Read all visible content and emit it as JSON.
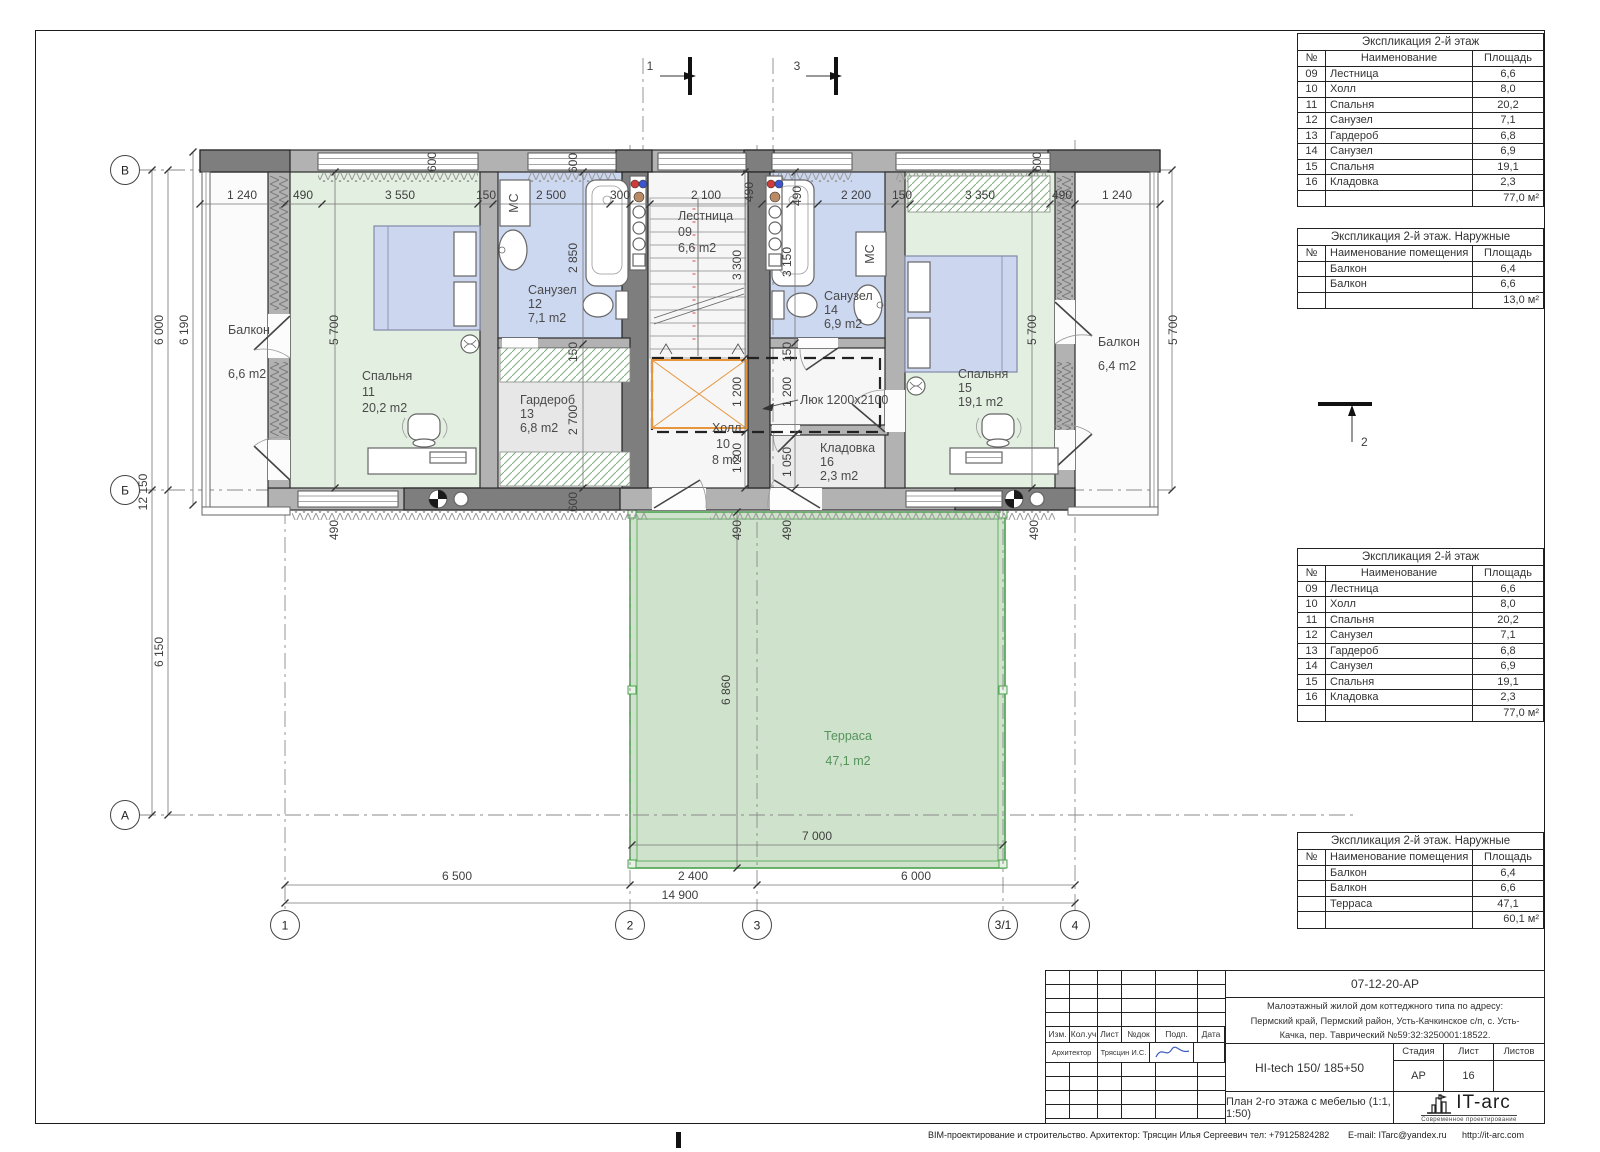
{
  "colors": {
    "wall": "#b2b2b2",
    "wall_dark": "#7e7e7e",
    "bedroom": "#e3efe0",
    "bath": "#ccd7f0",
    "wardrobe": "#e7e7e7",
    "terrace_fill": "#cfe2cb",
    "terrace_border": "#4aa14e",
    "bed": "#cdd6ef",
    "hatch_orange": "#e8963e"
  },
  "tables": {
    "floor": {
      "title": "Экспликация 2-й этаж",
      "cols": [
        "№",
        "Наименование",
        "Площадь"
      ],
      "rows": [
        [
          "09",
          "Лестница",
          "6,6"
        ],
        [
          "10",
          "Холл",
          "8,0"
        ],
        [
          "11",
          "Спальня",
          "20,2"
        ],
        [
          "12",
          "Санузел",
          "7,1"
        ],
        [
          "13",
          "Гардероб",
          "6,8"
        ],
        [
          "14",
          "Санузел",
          "6,9"
        ],
        [
          "15",
          "Спальня",
          "19,1"
        ],
        [
          "16",
          "Кладовка",
          "2,3"
        ]
      ],
      "total": "77,0 м²"
    },
    "outdoor_top": {
      "title": "Экспликация 2-й этаж. Наружные",
      "cols": [
        "№",
        "Наименование помещения",
        "Площадь"
      ],
      "rows": [
        [
          "",
          "Балкон",
          "6,4"
        ],
        [
          "",
          "Балкон",
          "6,6"
        ]
      ],
      "total": "13,0 м²"
    },
    "outdoor_bottom": {
      "title": "Экспликация 2-й этаж. Наружные",
      "cols": [
        "№",
        "Наименование помещения",
        "Площадь"
      ],
      "rows": [
        [
          "",
          "Балкон",
          "6,4"
        ],
        [
          "",
          "Балкон",
          "6,6"
        ],
        [
          "",
          "Терраса",
          "47,1"
        ]
      ],
      "total": "60,1 м²"
    }
  },
  "stamp": {
    "doc_number": "07-12-20-АР",
    "address1": "Малоэтажный жилой дом коттеджного типа по адресу:",
    "address2": "Пермский край, Пермский район, Усть-Качкинское с/п, с. Усть-",
    "address3": "Качка, пер. Таврический №59:32:3250001:18522.",
    "cols": [
      "Изм.",
      "Кол.уч",
      "Лист",
      "№док",
      "Подп.",
      "Дата"
    ],
    "grid_empty_top": [
      [
        "",
        "",
        "",
        "",
        "",
        ""
      ],
      [
        "",
        "",
        "",
        "",
        "",
        ""
      ],
      [
        "",
        "",
        "",
        "",
        "",
        ""
      ],
      [
        "",
        "",
        "",
        "",
        "",
        ""
      ]
    ],
    "grid_empty_bottom": [
      [
        "",
        "",
        "",
        "",
        "",
        ""
      ],
      [
        "",
        "",
        "",
        "",
        "",
        ""
      ],
      [
        "",
        "",
        "",
        "",
        "",
        ""
      ],
      [
        "",
        "",
        "",
        "",
        "",
        ""
      ]
    ],
    "architect_role": "Архитектор",
    "architect_name": "Трясцин И.С.",
    "project": "HI-tech 150/ 185+50",
    "stage_label": "Стадия",
    "sheet_label": "Лист",
    "sheets_label": "Листов",
    "stage": "АР",
    "sheet": "16",
    "sheets": "",
    "drawing_title": "План 2-го этажа с мебелью (1:1, 1:50)",
    "logo": "IT-arc",
    "logo_sub": "Современное проектирование"
  },
  "footer": {
    "item1": "BIM-проектирование и строительство.",
    "item2": "Архитектор: Трясцин Илья Сергеевич",
    "item3": "тел: +79125824282",
    "item4": "E-mail: ITarc@yandex.ru",
    "item5": "http://it-arc.com"
  },
  "plan": {
    "rooms": {
      "balcony_left": {
        "label": "Балкон",
        "area": "6,6 m2"
      },
      "bedroom11": {
        "label": "Спальня",
        "num": "11",
        "area": "20,2 m2"
      },
      "bath12": {
        "label": "Санузел",
        "num": "12",
        "area": "7,1 m2"
      },
      "wardrobe13": {
        "label": "Гардероб",
        "num": "13",
        "area": "6,8 m2"
      },
      "stairs09": {
        "label": "Лестница",
        "num": "09",
        "area": "6,6 m2"
      },
      "hall10": {
        "label": "Холл",
        "num": "10",
        "area": "8 m2"
      },
      "bath14": {
        "label": "Санузел",
        "num": "14",
        "area": "6,9 m2"
      },
      "storage16": {
        "label": "Кладовка",
        "num": "16",
        "area": "2,3 m2"
      },
      "bedroom15": {
        "label": "Спальня",
        "num": "15",
        "area": "19,1 m2"
      },
      "balcony_right": {
        "label": "Балкон",
        "area": "6,4 m2"
      },
      "terrace": {
        "label": "Терраса",
        "area": "47,1 m2"
      },
      "hatch": "Люк 1200х2100",
      "mc": "МС"
    },
    "axes": {
      "c1": "1",
      "c2": "2",
      "c3": "3",
      "c31": "3/1",
      "c4": "4",
      "rV": "В",
      "rB": "Б",
      "rA": "А"
    },
    "sections": {
      "s1": "1",
      "s2": "2",
      "s3": "3"
    },
    "dims": {
      "top": [
        "1 240",
        "490",
        "3 550",
        "150",
        "2 500",
        "300",
        "2 100",
        "490",
        "490",
        "2 200",
        "150",
        "3 350",
        "490",
        "1 240"
      ],
      "bottom": [
        "6 500",
        "2 400",
        "6 000",
        "14 900"
      ],
      "left": [
        "6 000",
        "6 190",
        "12 150",
        "6 150"
      ],
      "v5700": [
        "5 700",
        "5 700",
        "5 700"
      ],
      "c583": [
        "600",
        "2 850",
        "150",
        "2 700",
        "600"
      ],
      "c745": [
        "3 300",
        "1 200",
        "1 200",
        "490"
      ],
      "c795": [
        "3 150",
        "150",
        "1 200",
        "1 050",
        "490"
      ],
      "w600": [
        "600",
        "600"
      ],
      "b490": [
        "490",
        "490"
      ],
      "terrace": [
        "6 860",
        "7 000"
      ]
    }
  }
}
